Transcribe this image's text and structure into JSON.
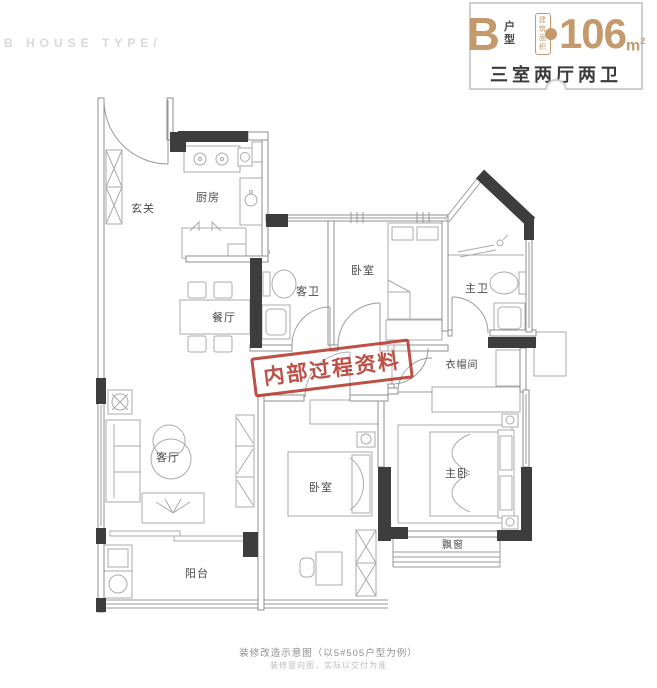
{
  "watermark": "B HOUSE TYPE/",
  "header": {
    "type_letter": "B",
    "type_label_line1": "户",
    "type_label_line2": "型",
    "area_label_line1": "建筑",
    "area_label_line2": "面积",
    "area_approx": "约",
    "area_value": "106",
    "area_unit": "m",
    "area_unit_sup": "2",
    "layout_summary": "三室两厅两卫",
    "accent_color": "#c49a6c"
  },
  "stamp": {
    "text": "内部过程资料",
    "color": "#b4382e"
  },
  "plan": {
    "wall_color": "#3d3d3d",
    "line_color": "#9a9a9a",
    "rooms": {
      "foyer": "玄关",
      "kitchen": "厨房",
      "dining": "餐厅",
      "guest_bath": "客卫",
      "bedroom_north": "卧室",
      "master_bath": "主卫",
      "cloakroom": "衣帽间",
      "living": "客厅",
      "bedroom_south": "卧室",
      "master_bedroom": "主卧",
      "bay_window": "飘窗",
      "balcony": "阳台"
    }
  },
  "footer": {
    "caption": "装修改造示意图（以5#505户型为例）",
    "disclaimer": "装修意向图，实际以交付为准"
  }
}
